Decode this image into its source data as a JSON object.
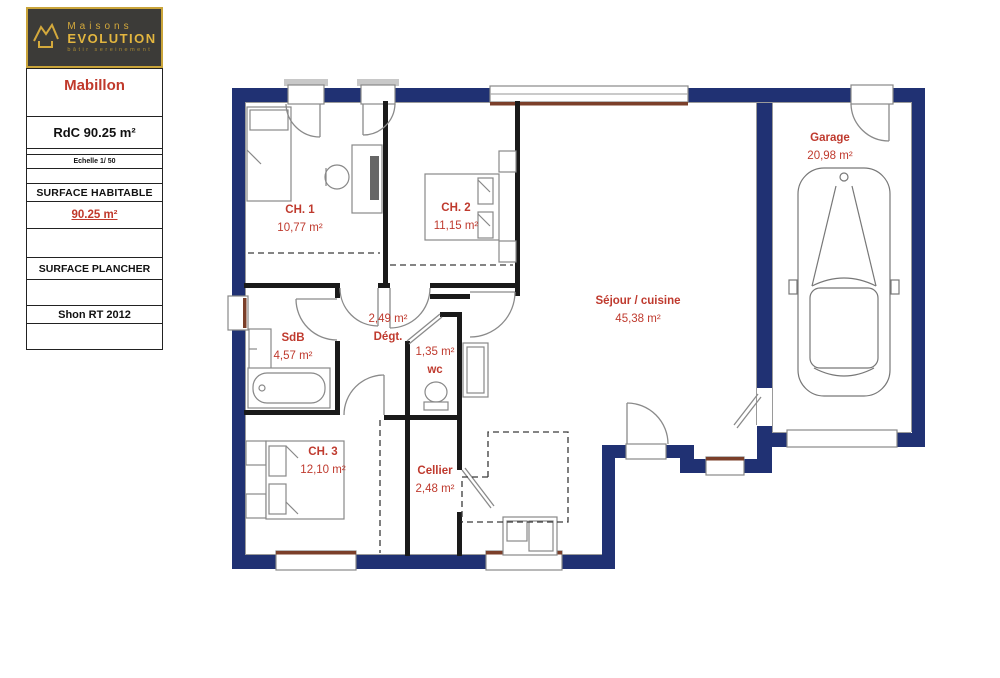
{
  "sidebar": {
    "logo": {
      "brand_line1": "Maisons",
      "brand_line2": "EVOLUTION",
      "tagline": "bâtir sereinement"
    },
    "model_name": "Mabillon",
    "floor_label": "RdC 90.25 m²",
    "scale_label": "Echelle 1/ 50",
    "surface_habitable_label": "SURFACE HABITABLE",
    "surface_habitable_value": "90.25 m²",
    "surface_plancher_label": "SURFACE PLANCHER",
    "shon_label": "Shon RT 2012"
  },
  "plan": {
    "colors": {
      "exterior_wall": "#203173",
      "interior_wall": "#1a1a1a",
      "room_label": "#bf3a2e",
      "window_sill": "#7b3f2a"
    },
    "rooms": [
      {
        "id": "ch1",
        "name": "CH. 1",
        "area": "10,77 m²"
      },
      {
        "id": "ch2",
        "name": "CH. 2",
        "area": "11,15 m²"
      },
      {
        "id": "garage",
        "name": "Garage",
        "area": "20,98 m²"
      },
      {
        "id": "sejour",
        "name": "Séjour / cuisine",
        "area": "45,38 m²"
      },
      {
        "id": "sdb",
        "name": "SdB",
        "area": "4,57 m²"
      },
      {
        "id": "degt",
        "name": "Dégt.",
        "area": "2,49 m²"
      },
      {
        "id": "wc",
        "name": "wc",
        "area": "1,35 m²"
      },
      {
        "id": "ch3",
        "name": "CH. 3",
        "area": "12,10 m²"
      },
      {
        "id": "cellier",
        "name": "Cellier",
        "area": "2,48 m²"
      }
    ]
  }
}
